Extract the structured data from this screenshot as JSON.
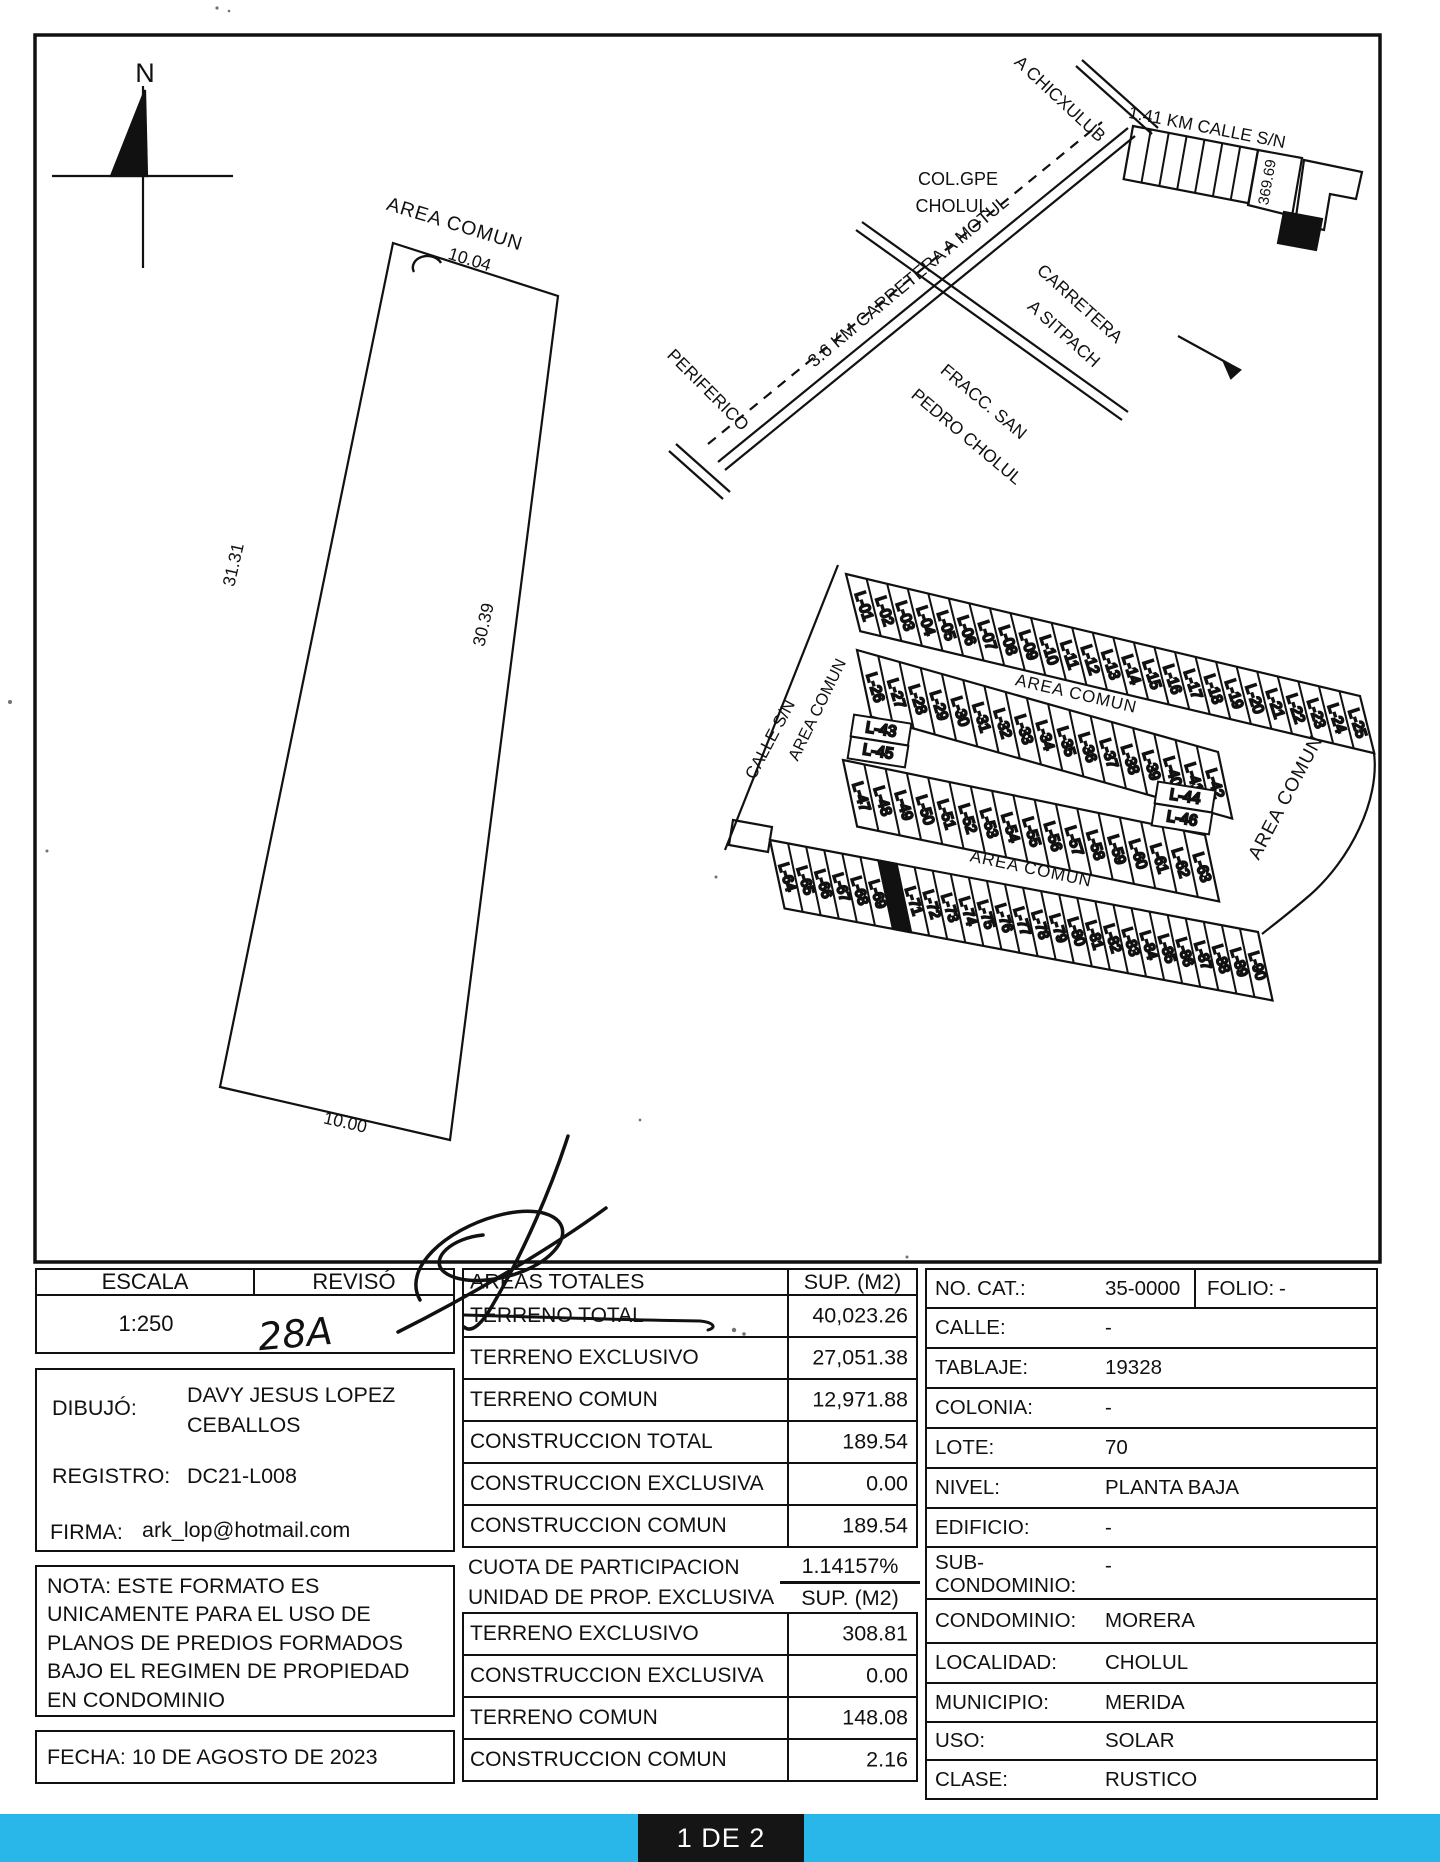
{
  "colors": {
    "accent_bar": "#29b6e8",
    "ink": "#111111",
    "highlight_lot_fill": "#111111"
  },
  "footer": {
    "page_indicator": "1 DE 2"
  },
  "compass": {
    "north_label": "N"
  },
  "parcel": {
    "area_label": "AREA COMUN",
    "dim_top": "10.04",
    "dim_left": "31.31",
    "dim_right": "30.39",
    "dim_bottom": "10.00"
  },
  "location_map": {
    "chicxulub": "A CHICXULUB",
    "calle_sn": "1.41 KM CALLE S/N",
    "frontage": "369.69",
    "colonia_line1": "COL.GPE",
    "colonia_line2": "CHOLUL",
    "sitpach_line1": "CARRETERA",
    "sitpach_line2": "A SITPACH",
    "motul": "3.6 KM CARRETERA A MOTUL",
    "fracc_line1": "FRACC. SAN",
    "fracc_line2": "PEDRO CHOLUL",
    "periferico": "PERIFERICO"
  },
  "site_plan": {
    "calle_label": "CALLE S/N",
    "area_left": "AREA COMUN",
    "area_upper": "AREA COMUN",
    "area_lower": "AREA COMUN",
    "area_right": "AREA COMUN",
    "highlighted_lot": "L-70",
    "rows": {
      "row1": [
        "L-01",
        "L-02",
        "L-03",
        "L-04",
        "L-05",
        "L-06",
        "L-07",
        "L-08",
        "L-09",
        "L-10",
        "L-11",
        "L-12",
        "L-13",
        "L-14",
        "L-15",
        "L-16",
        "L-17",
        "L-18",
        "L-19",
        "L-20",
        "L-21",
        "L-22",
        "L-23",
        "L-24",
        "L-25"
      ],
      "row2": [
        "L-26",
        "L-27",
        "L-28",
        "L-29",
        "L-30",
        "L-31",
        "L-32",
        "L-33",
        "L-34",
        "L-35",
        "L-36",
        "L-37",
        "L-38",
        "L-39",
        "L-40",
        "L-41",
        "L-42"
      ],
      "row3": [
        "L-47",
        "L-48",
        "L-49",
        "L-50",
        "L-51",
        "L-52",
        "L-53",
        "L-54",
        "L-55",
        "L-56",
        "L-57",
        "L-58",
        "L-59",
        "L-60",
        "L-61",
        "L-62",
        "L-63"
      ],
      "row4": [
        "L-64",
        "L-65",
        "L-66",
        "L-67",
        "L-68",
        "L-69",
        "L-70",
        "L-71",
        "L-72",
        "L-73",
        "L-74",
        "L-75",
        "L-76",
        "L-77",
        "L-78",
        "L-79",
        "L-80",
        "L-81",
        "L-82",
        "L-83",
        "L-84",
        "L-85",
        "L-86",
        "L-87",
        "L-88",
        "L-89",
        "L-90"
      ]
    },
    "wide_lots": [
      "L-43",
      "L-45",
      "L-44",
      "L-46"
    ]
  },
  "tables": {
    "escala": {
      "label": "ESCALA",
      "value": "1:250"
    },
    "reviso": {
      "label": "REVISÓ",
      "value": "28A"
    },
    "dibujo": {
      "label": "DIBUJÓ:",
      "value": "DAVY JESUS LOPEZ\nCEBALLOS"
    },
    "registro": {
      "label": "REGISTRO:",
      "value": "DC21-L008"
    },
    "firma": {
      "label": "FIRMA:",
      "value": "ark_lop@hotmail.com"
    },
    "nota": "NOTA: ESTE FORMATO ES\nUNICAMENTE PARA EL USO DE\nPLANOS DE PREDIOS FORMADOS\nBAJO EL REGIMEN DE PROPIEDAD\nEN CONDOMINIO",
    "fecha": "FECHA: 10 DE AGOSTO DE 2023"
  },
  "areas_totales": {
    "title": "AREAS TOTALES",
    "unit_header": "SUP. (M2)",
    "rows": [
      {
        "label": "TERRENO TOTAL",
        "value": "40,023.26",
        "struck": true
      },
      {
        "label": "TERRENO EXCLUSIVO",
        "value": "27,051.38"
      },
      {
        "label": "TERRENO COMUN",
        "value": "12,971.88"
      },
      {
        "label": "CONSTRUCCION TOTAL",
        "value": "189.54"
      },
      {
        "label": "CONSTRUCCION EXCLUSIVA",
        "value": "0.00"
      },
      {
        "label": "CONSTRUCCION COMUN",
        "value": "189.54"
      }
    ],
    "cuota_label": "CUOTA DE PARTICIPACION",
    "cuota_value": "1.14157%",
    "unidad_label": "UNIDAD DE PROP. EXCLUSIVA",
    "unidad_unit_header": "SUP. (M2)",
    "unidad_rows": [
      {
        "label": "TERRENO EXCLUSIVO",
        "value": "308.81"
      },
      {
        "label": "CONSTRUCCION EXCLUSIVA",
        "value": "0.00"
      },
      {
        "label": "TERRENO COMUN",
        "value": "148.08"
      },
      {
        "label": "CONSTRUCCION COMUN",
        "value": "2.16"
      }
    ]
  },
  "predio": {
    "rows": [
      {
        "label": "NO. CAT.:",
        "value": "35-0000",
        "label2": "FOLIO:",
        "value2": "-"
      },
      {
        "label": "CALLE:",
        "value": "-"
      },
      {
        "label": "TABLAJE:",
        "value": "19328"
      },
      {
        "label": "COLONIA:",
        "value": "-"
      },
      {
        "label": "LOTE:",
        "value": "70"
      },
      {
        "label": "NIVEL:",
        "value": "PLANTA BAJA"
      },
      {
        "label": "EDIFICIO:",
        "value": "-"
      },
      {
        "label": "SUB-\nCONDOMINIO:",
        "value": "-"
      },
      {
        "label": "CONDOMINIO:",
        "value": "MORERA"
      },
      {
        "label": "LOCALIDAD:",
        "value": "CHOLUL"
      },
      {
        "label": "MUNICIPIO:",
        "value": "MERIDA"
      },
      {
        "label": "USO:",
        "value": "SOLAR"
      },
      {
        "label": "CLASE:",
        "value": "RUSTICO"
      }
    ]
  }
}
